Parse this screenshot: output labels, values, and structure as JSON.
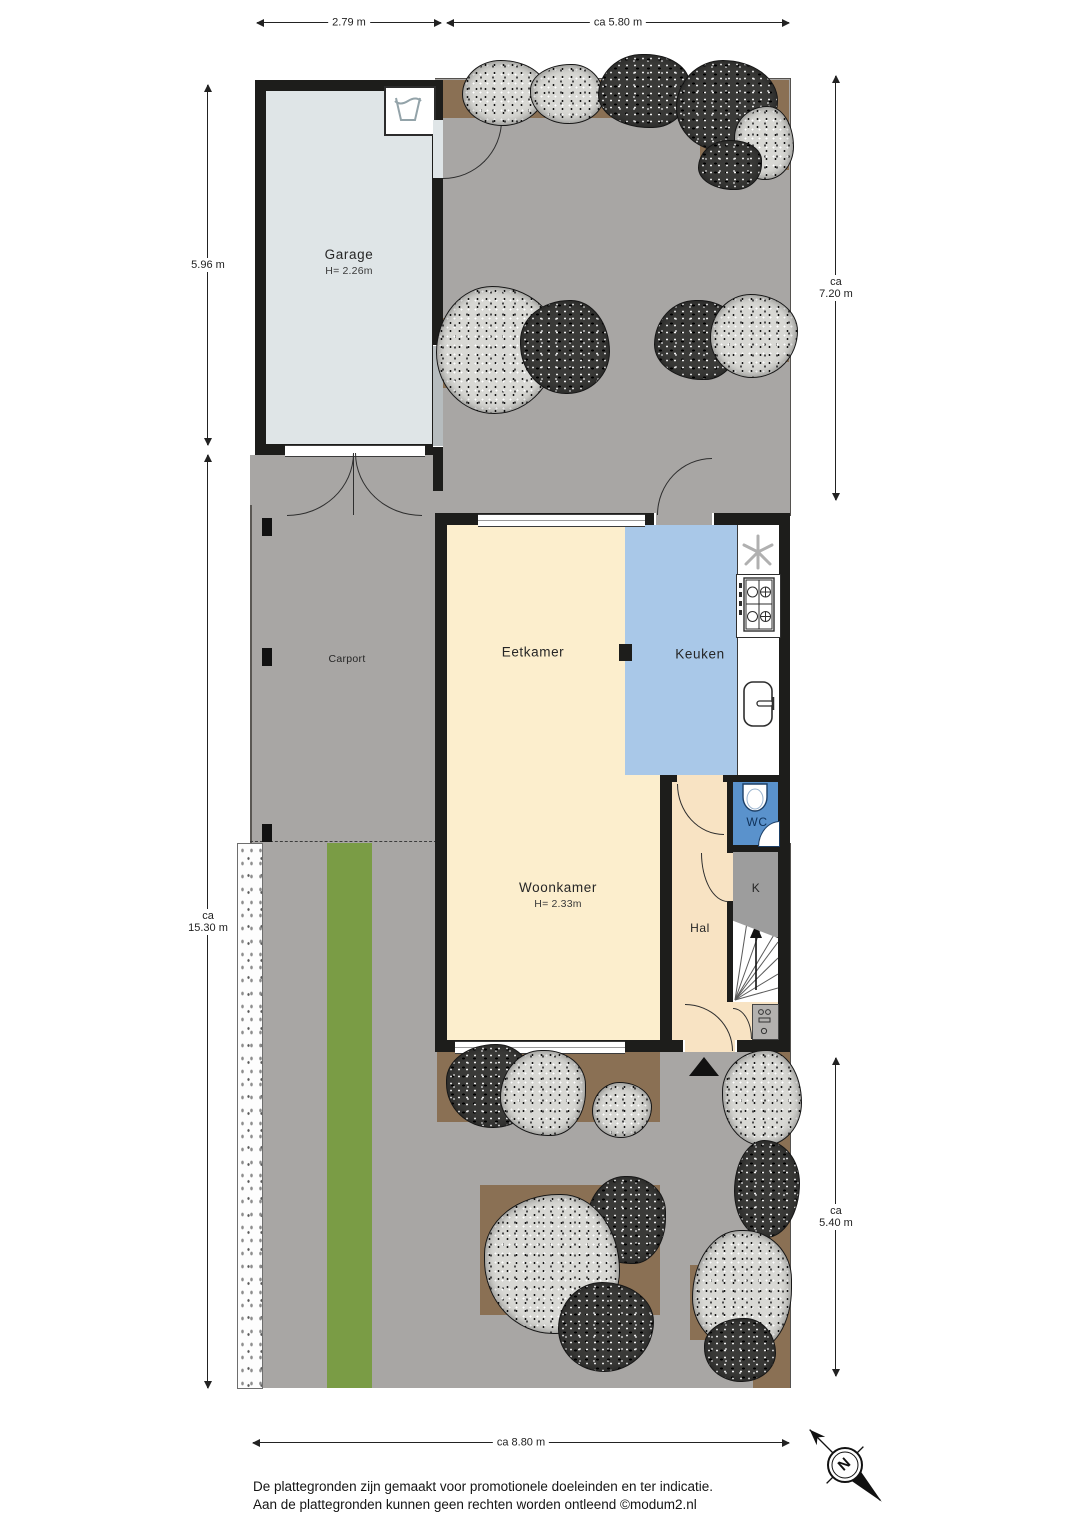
{
  "rooms": {
    "garage": {
      "label": "Garage",
      "height": "H= 2.26m"
    },
    "carport": {
      "label": "Carport"
    },
    "eetkamer": {
      "label": "Eetkamer"
    },
    "keuken": {
      "label": "Keuken"
    },
    "woonkamer": {
      "label": "Woonkamer",
      "height": "H= 2.33m"
    },
    "hal": {
      "label": "Hal"
    },
    "wc": {
      "label": "WC"
    },
    "kast": {
      "label": "K"
    }
  },
  "dimensions": {
    "top_garage": "2.79 m",
    "top_garden": "ca 5.80 m",
    "left_garage": "5.96 m",
    "left_plot_ca": "ca",
    "left_plot": "15.30 m",
    "right_garden_ca": "ca",
    "right_garden": "7.20 m",
    "right_front_ca": "ca",
    "right_front": "5.40 m",
    "bottom": "ca  8.80 m"
  },
  "compass": {
    "north_label": "N"
  },
  "footer": {
    "line1": "De plattegronden zijn gemaakt voor promotionele doeleinden en ter indicatie.",
    "line2": "Aan de plattegronden kunnen geen rechten worden ontleend ©modum2.nl"
  },
  "colors": {
    "paving": "#a8a6a4",
    "planting_bed": "#8a7054",
    "grass": "#7a9c45",
    "wall": "#1d1d1b",
    "living_cream": "#fceecd",
    "hall_peach": "#f8e3c3",
    "kitchen_blue": "#a9c8e8",
    "wc_blue": "#5a92cc",
    "closet_gray": "#9d9d9d",
    "garage_gray": "#dfe5e7"
  }
}
